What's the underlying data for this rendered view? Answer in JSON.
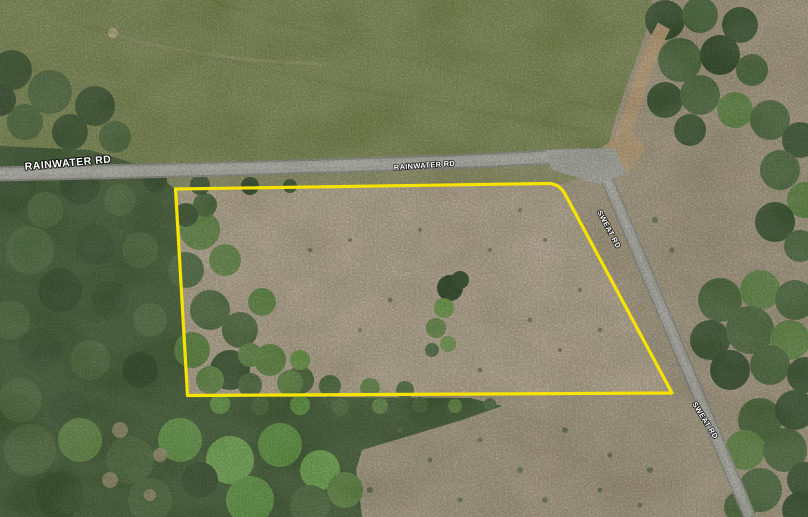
{
  "map": {
    "description": "aerial parcel map with outlined property boundary",
    "labels": {
      "rainwater_left": "RAINWATER RD",
      "rainwater_center": "RAINWATER RD",
      "sweat_upper": "SWEAT RD",
      "sweat_lower": "SWEAT RD"
    },
    "boundary": {
      "color": "#F6E300"
    },
    "label_text_color": "#FFFFFF",
    "label_outline_color": "#000000"
  }
}
